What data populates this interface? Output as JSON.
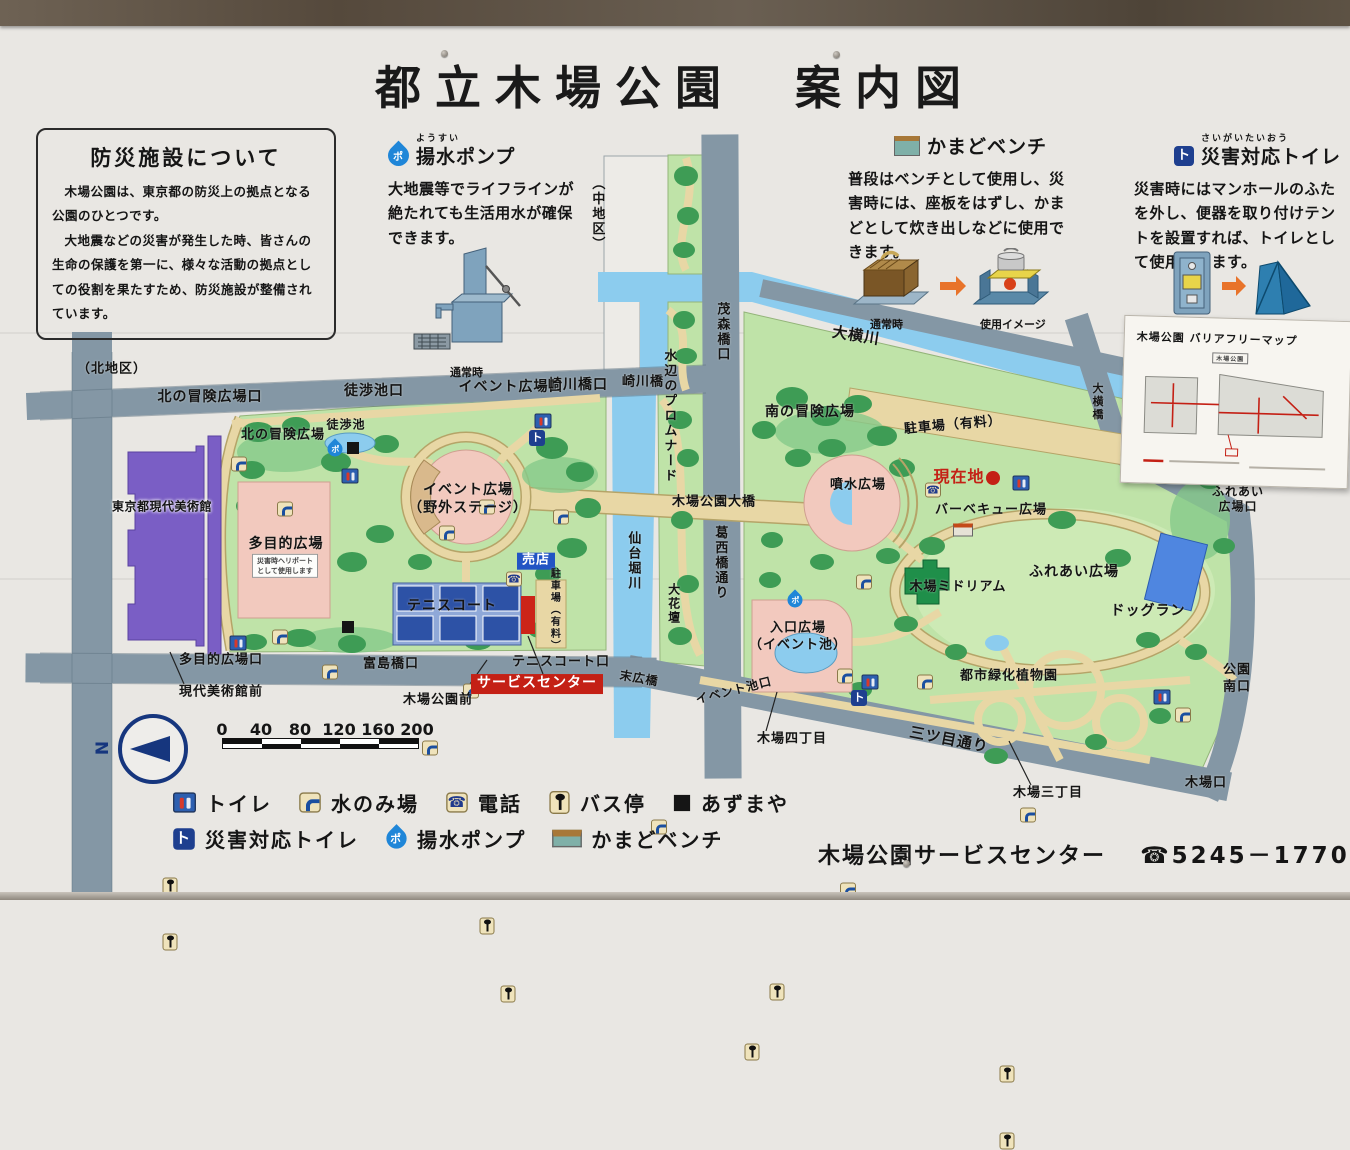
{
  "title": "都立木場公園　案内図",
  "info_box": {
    "title": "防災施設について",
    "p1": "木場公園は、東京都の防災上の拠点となる公園のひとつです。",
    "p2": "大地震などの災害が発生した時、皆さんの生命の保護を第一に、様々な活動の拠点としての役割を果たすため、防災施設が整備されています。"
  },
  "sections": {
    "pump": {
      "ruby": "ようすい",
      "title": "揚水ポンプ",
      "badge": "ポ",
      "body": "大地震等でライフラインが絶たれても生活用水が確保できます。",
      "caption_normal": "通常時"
    },
    "kamado": {
      "title": "かまどベンチ",
      "body": "普段はベンチとして使用し、災害時には、座板をはずし、かまどとして炊き出しなどに使用できます。",
      "caption_normal": "通常時",
      "caption_use": "使用イメージ"
    },
    "dtoilet": {
      "ruby": "さいがいたいおう",
      "title": "災害対応トイレ",
      "badge": "ト",
      "body": "災害時にはマンホールのふたを外し、便器を取り付けテントを設置すれば、トイレとして使用できます。",
      "caption_normal": "通常時",
      "caption_use": "使用イメージ"
    }
  },
  "inset": {
    "title": "木場公園 バリアフリーマップ",
    "map_label": "木場公園"
  },
  "legend": {
    "row1": [
      {
        "icon": "toilet-icon",
        "label": "トイレ"
      },
      {
        "icon": "water-fountain-icon",
        "label": "水のみ場"
      },
      {
        "icon": "phone-icon",
        "label": "電話"
      },
      {
        "icon": "bus-stop-icon",
        "label": "バス停"
      },
      {
        "icon": "azumaya-icon",
        "label": "あずまや"
      }
    ],
    "row2": [
      {
        "icon": "disaster-toilet-icon",
        "label": "災害対応トイレ"
      },
      {
        "icon": "pump-icon",
        "label": "揚水ポンプ"
      },
      {
        "icon": "kamado-bench-icon",
        "label": "かまどベンチ"
      }
    ]
  },
  "scale": {
    "ticks": [
      "0",
      "40",
      "80",
      "120",
      "160",
      "200"
    ]
  },
  "compass": {
    "n": "N"
  },
  "footer": {
    "name": "木場公園サービスセンター",
    "phone": "☎5245－1770"
  },
  "map": {
    "labels": [
      {
        "t": "（北地区）",
        "x": 112,
        "y": 370,
        "fs": 13
      },
      {
        "t": "北の冒険広場口",
        "x": 210,
        "y": 398,
        "fs": 14
      },
      {
        "t": "徒渉池口",
        "x": 374,
        "y": 392,
        "fs": 14
      },
      {
        "t": "イベント広場口",
        "x": 511,
        "y": 388,
        "fs": 14
      },
      {
        "t": "崎川橋口",
        "x": 578,
        "y": 386,
        "fs": 14
      },
      {
        "t": "崎川橋",
        "x": 643,
        "y": 383,
        "fs": 13
      },
      {
        "t": "（中地区）",
        "x": 596,
        "y": 214,
        "fs": 13,
        "v": 1
      },
      {
        "t": "茂森橋口",
        "x": 721,
        "y": 332,
        "fs": 13,
        "v": 1
      },
      {
        "t": "大横川",
        "x": 856,
        "y": 336,
        "fs": 15,
        "r": 9
      },
      {
        "t": "水辺のプロムナード",
        "x": 668,
        "y": 416,
        "fs": 13,
        "v": 1
      },
      {
        "t": "南の冒険広場",
        "x": 810,
        "y": 413,
        "fs": 14
      },
      {
        "t": "駐車場（有料）",
        "x": 953,
        "y": 426,
        "fs": 13,
        "r": -5
      },
      {
        "t": "現在地",
        "x": 959,
        "y": 477,
        "fs": 16,
        "c": "red"
      },
      {
        "t": "噴水広場",
        "x": 858,
        "y": 486,
        "fs": 13
      },
      {
        "t": "木場公園大橋",
        "x": 714,
        "y": 503,
        "fs": 13
      },
      {
        "t": "葛西橋通り",
        "x": 719,
        "y": 563,
        "fs": 13,
        "v": 1
      },
      {
        "t": "仙台堀川",
        "x": 632,
        "y": 561,
        "fs": 13,
        "v": 1
      },
      {
        "t": "大花壇",
        "x": 673,
        "y": 604,
        "fs": 12,
        "v": 1
      },
      {
        "t": "バーベキュー広場",
        "x": 991,
        "y": 511,
        "fs": 13
      },
      {
        "t": "木場ミドリアム",
        "x": 958,
        "y": 588,
        "fs": 13
      },
      {
        "t": "ふれあい広場",
        "x": 1074,
        "y": 573,
        "fs": 14
      },
      {
        "t": "ドッグラン",
        "x": 1148,
        "y": 612,
        "fs": 14
      },
      {
        "t": "大横橋",
        "x": 1097,
        "y": 402,
        "fs": 11,
        "v": 1
      },
      {
        "t": "ふれあい\n広場口",
        "x": 1238,
        "y": 500,
        "fs": 12
      },
      {
        "t": "公園\n南口",
        "x": 1237,
        "y": 679,
        "fs": 13
      },
      {
        "t": "木場口",
        "x": 1206,
        "y": 784,
        "fs": 13
      },
      {
        "t": "三ツ目通り",
        "x": 949,
        "y": 740,
        "fs": 15,
        "r": 11
      },
      {
        "t": "木場三丁目",
        "x": 1048,
        "y": 794,
        "fs": 13
      },
      {
        "t": "木場四丁目",
        "x": 792,
        "y": 740,
        "fs": 13
      },
      {
        "t": "イベント池口",
        "x": 734,
        "y": 691,
        "fs": 12,
        "r": -14
      },
      {
        "t": "入口広場\n（イベント池）",
        "x": 798,
        "y": 637,
        "fs": 13
      },
      {
        "t": "都市緑化植物園",
        "x": 1009,
        "y": 677,
        "fs": 13
      },
      {
        "t": "東京都現代美術館",
        "x": 162,
        "y": 507,
        "fs": 12,
        "c": "mus"
      },
      {
        "t": "北の冒険広場",
        "x": 283,
        "y": 436,
        "fs": 13
      },
      {
        "t": "徒渉池",
        "x": 346,
        "y": 425,
        "fs": 12
      },
      {
        "t": "多目的広場",
        "x": 286,
        "y": 545,
        "fs": 14
      },
      {
        "t": "災害時ヘリポート\nとして使用します",
        "x": 285,
        "y": 566,
        "fs": 7,
        "c": "note"
      },
      {
        "t": "多目的広場口",
        "x": 221,
        "y": 661,
        "fs": 13
      },
      {
        "t": "現代美術館前",
        "x": 221,
        "y": 693,
        "fs": 13
      },
      {
        "t": "富島橋口",
        "x": 391,
        "y": 665,
        "fs": 13
      },
      {
        "t": "イベント広場\n（野外ステージ）",
        "x": 468,
        "y": 500,
        "fs": 14
      },
      {
        "t": "売店",
        "x": 536,
        "y": 561,
        "fs": 13,
        "c": "bluebox"
      },
      {
        "t": "テニスコート",
        "x": 452,
        "y": 607,
        "fs": 14
      },
      {
        "t": "駐車場（有料）",
        "x": 553,
        "y": 610,
        "fs": 10,
        "v": 1
      },
      {
        "t": "テニスコート口",
        "x": 561,
        "y": 663,
        "fs": 13
      },
      {
        "t": "サービスセンター",
        "x": 537,
        "y": 684,
        "fs": 14,
        "c": "redbox"
      },
      {
        "t": "木場公園前",
        "x": 438,
        "y": 701,
        "fs": 13
      },
      {
        "t": "末広橋",
        "x": 639,
        "y": 679,
        "fs": 12,
        "r": 10
      }
    ],
    "icons": [
      {
        "k": "toilet",
        "x": 350,
        "y": 476
      },
      {
        "k": "toilet",
        "x": 543,
        "y": 421
      },
      {
        "k": "toilet",
        "x": 238,
        "y": 643
      },
      {
        "k": "toilet",
        "x": 1021,
        "y": 483
      },
      {
        "k": "toilet",
        "x": 870,
        "y": 682
      },
      {
        "k": "toilet",
        "x": 1162,
        "y": 697
      },
      {
        "k": "tap",
        "x": 239,
        "y": 464
      },
      {
        "k": "tap",
        "x": 285,
        "y": 494
      },
      {
        "k": "tap",
        "x": 280,
        "y": 607
      },
      {
        "k": "tap",
        "x": 330,
        "y": 627
      },
      {
        "k": "tap",
        "x": 447,
        "y": 473
      },
      {
        "k": "tap",
        "x": 487,
        "y": 432
      },
      {
        "k": "tap",
        "x": 561,
        "y": 427
      },
      {
        "k": "tap",
        "x": 471,
        "y": 586
      },
      {
        "k": "tap",
        "x": 430,
        "y": 628
      },
      {
        "k": "tap",
        "x": 864,
        "y": 447
      },
      {
        "k": "tap",
        "x": 845,
        "y": 526
      },
      {
        "k": "tap",
        "x": 925,
        "y": 517
      },
      {
        "k": "tap",
        "x": 1183,
        "y": 535
      },
      {
        "k": "tap",
        "x": 1028,
        "y": 620
      },
      {
        "k": "tap",
        "x": 848,
        "y": 680
      },
      {
        "k": "tap",
        "x": 659,
        "y": 602
      },
      {
        "k": "phone",
        "x": 514,
        "y": 579
      },
      {
        "k": "phone",
        "x": 933,
        "y": 490
      },
      {
        "k": "pump",
        "x": 335,
        "y": 449
      },
      {
        "k": "pump",
        "x": 795,
        "y": 600
      },
      {
        "k": "dtoilet",
        "x": 537,
        "y": 438
      },
      {
        "k": "dtoilet",
        "x": 859,
        "y": 698
      },
      {
        "k": "az",
        "x": 353,
        "y": 448
      },
      {
        "k": "az",
        "x": 348,
        "y": 627
      },
      {
        "k": "bus",
        "x": 170,
        "y": 646
      },
      {
        "k": "bus",
        "x": 170,
        "y": 685
      },
      {
        "k": "bus",
        "x": 487,
        "y": 652
      },
      {
        "k": "bus",
        "x": 508,
        "y": 703
      },
      {
        "k": "bus",
        "x": 777,
        "y": 684
      },
      {
        "k": "bus",
        "x": 752,
        "y": 727
      },
      {
        "k": "bus",
        "x": 1007,
        "y": 732
      },
      {
        "k": "bus",
        "x": 1007,
        "y": 782
      },
      {
        "k": "here",
        "x": 993,
        "y": 478
      },
      {
        "k": "shelter",
        "x": 963,
        "y": 530
      }
    ]
  }
}
